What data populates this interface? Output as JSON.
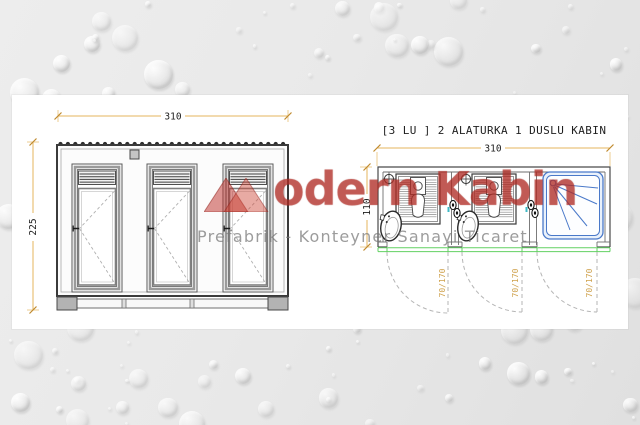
{
  "watermark": {
    "brand_initial": "M",
    "brand_rest": "odern Kabin",
    "tagline": "Prefabrik - Konteyner Sanayi Ticaret",
    "brand_color": "#c1342b",
    "tagline_color": "#767676"
  },
  "elevation": {
    "width_label": "310",
    "height_label": "225"
  },
  "plan": {
    "title": "[3 LU ] 2 ALATURKA 1 DUSLU KABIN",
    "width_label": "310",
    "depth_label": "110",
    "door_swing_labels": [
      "70/170",
      "70/170",
      "70/170"
    ],
    "fixtures": [
      "alaturka-toilet",
      "alaturka-toilet",
      "shower-tray"
    ]
  },
  "colors": {
    "dimension_line": "#e5b55e",
    "dimension_text": "#1c1c1c",
    "swing_label": "#cfa14c",
    "threshold_green": "#62d162",
    "shower_blue": "#4a79c9",
    "drawing_gray": "#4a4a4a",
    "watermark_red": "#c1342b",
    "panel_background": "#ffffff",
    "page_background": "#e9e9e9"
  }
}
